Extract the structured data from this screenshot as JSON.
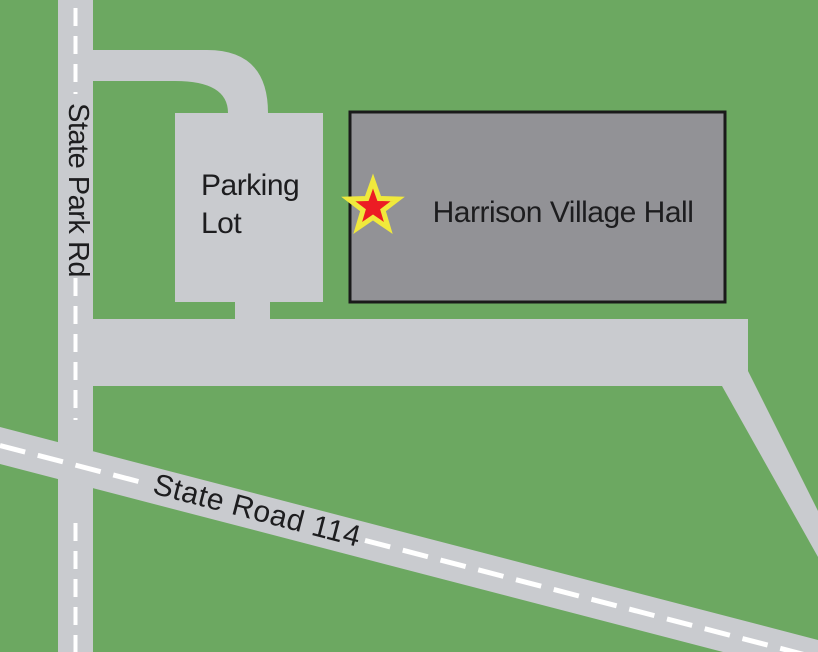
{
  "labels": {
    "state_park_rd": "State Park Rd",
    "state_road_114": "State Road 114",
    "parking_line1": "Parking",
    "parking_line2": "Lot",
    "village_hall": "Harrison Village Hall"
  },
  "colors": {
    "grass": "#6CA861",
    "road": "#C9CBCF",
    "building_fill": "#929296",
    "building_border": "#1A1A1A",
    "center_line": "#FFFFFF",
    "marker_fill": "#EC1C24",
    "marker_border": "#F0E93C",
    "label_text": "#1D1D1F"
  },
  "marker": {
    "type": "star",
    "location": "Harrison Village Hall entrance"
  }
}
